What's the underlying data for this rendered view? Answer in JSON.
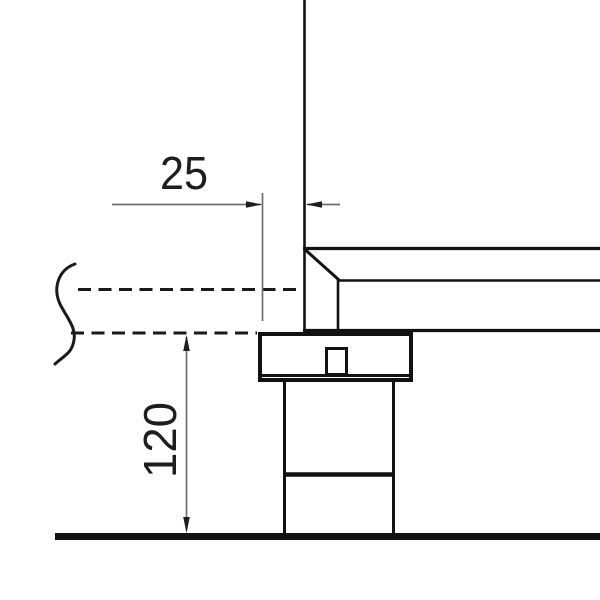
{
  "drawing": {
    "kind": "technical-section-drawing",
    "background": "#ffffff",
    "colors": {
      "outline": "#121212",
      "outline_light": "#1a1a1a",
      "dim_line": "#6f6f6f",
      "dim_marker": "#1e1e1e",
      "text": "#1e1e1e",
      "fill_white": "#ffffff"
    },
    "dimensions": {
      "offset": {
        "value": "25"
      },
      "height": {
        "value": "120"
      }
    }
  }
}
